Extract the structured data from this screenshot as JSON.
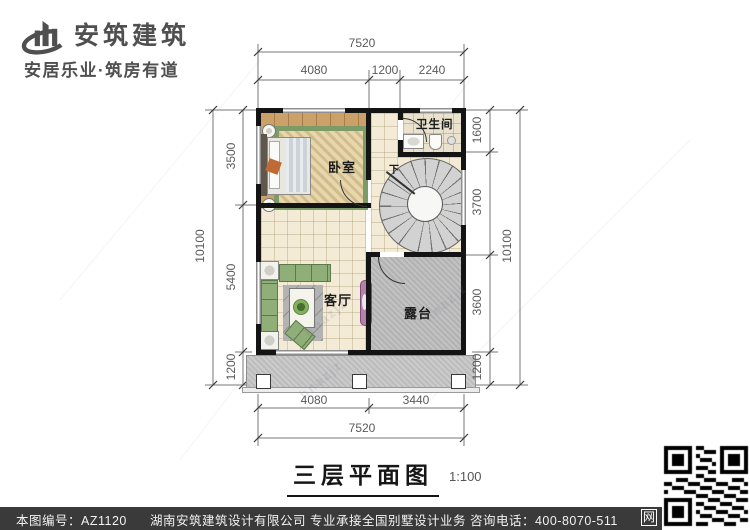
{
  "header": {
    "brand": "安筑建筑",
    "tagline": "安居乐业·筑房有道"
  },
  "plan": {
    "title": "三层平面图",
    "scale": "1:100",
    "watermark": "hnazjz",
    "rooms": {
      "bedroom": "卧室",
      "bathroom": "卫生间",
      "living": "客厅",
      "terrace": "露台",
      "stair_down": "下"
    },
    "dims": {
      "top_total": "7520",
      "top_segs": [
        "4080",
        "1200",
        "2240"
      ],
      "bottom_segs": [
        "4080",
        "3440"
      ],
      "bottom_total": "7520",
      "left_total": "10100",
      "left_segs": [
        "3500",
        "5400",
        "1200"
      ],
      "right_segs": [
        "1600",
        "3700",
        "3600",
        "1200"
      ],
      "right_total": "10100"
    }
  },
  "footer": {
    "drawing_code": "本图编号：AZ1120",
    "company_line": "湖南安筑建筑设计有限公司  专业承接全国别墅设计业务  咨询电话：400-8070-511",
    "qr_caption": "网"
  },
  "colors": {
    "wall": "#141414",
    "wood_floor": "#cba169",
    "tile_floor": "#f3ebd6",
    "terrace_floor": "#bcbcbc",
    "footer_bg": "#3a3a3a",
    "dim_text": "#5a5a5a",
    "brand_text": "#4f4f4f"
  }
}
